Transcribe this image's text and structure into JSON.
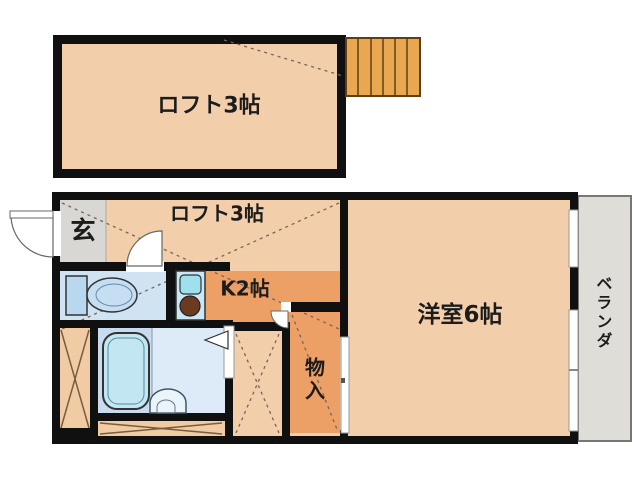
{
  "plan_title": "1K loft apartment floor plan",
  "rooms": {
    "loft_upper": {
      "label": "ロフト3帖"
    },
    "loft_lower": {
      "label": "ロフト3帖"
    },
    "entrance": {
      "label": "玄"
    },
    "kitchen": {
      "label": "K2帖"
    },
    "storage": {
      "label": "物入"
    },
    "western_room": {
      "label": "洋室6帖"
    },
    "veranda": {
      "label": "ベランダ"
    }
  },
  "fixtures": [
    "staircase",
    "toilet",
    "kitchen-sink",
    "stove-burner",
    "bathtub",
    "washbasin",
    "entrance-door",
    "room-door",
    "closet-door",
    "sliding-window"
  ],
  "colors": {
    "wall": "#101010",
    "floor_peach": "#F3CEAA",
    "floor_orange": "#ECA066",
    "floor_gray": "#D8D7D3",
    "floor_blue_toilet": "#CFE3F3",
    "floor_blue_bath": "#DCEBF7",
    "stairs_orange": "#E9A750",
    "veranda_gray": "#DEDDD8"
  }
}
